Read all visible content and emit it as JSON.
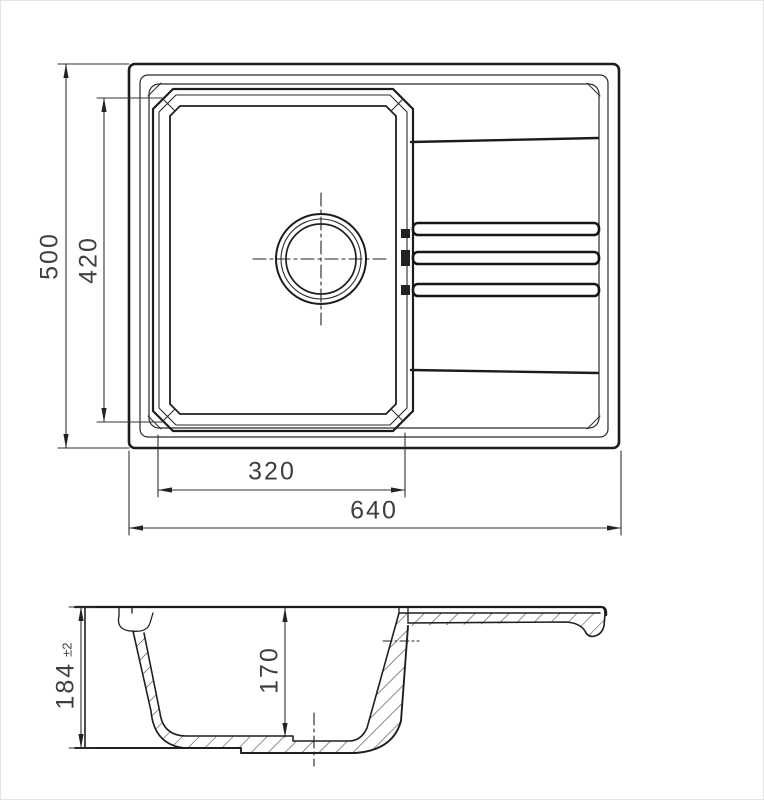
{
  "plan": {
    "overall_depth": "500",
    "bowl_length": "420",
    "bowl_width": "320",
    "overall_width": "640"
  },
  "section": {
    "overall_height": "184",
    "height_tolerance": "±2",
    "bowl_depth": "170"
  }
}
